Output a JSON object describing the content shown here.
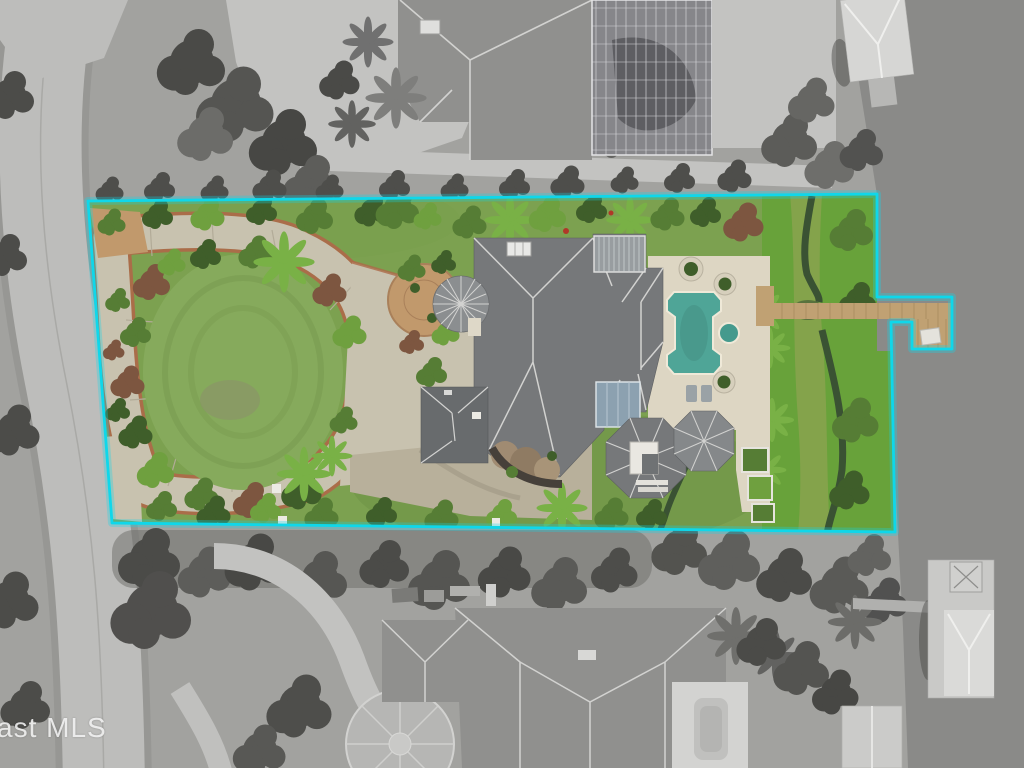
{
  "meta": {
    "kind": "aerial-drone-real-estate-photo",
    "subject": "Waterfront estate lot outlined in cyan; lot shown in color, surroundings desaturated grayscale",
    "width": 1024,
    "height": 768
  },
  "watermark": {
    "text": "ast MLS"
  },
  "scene": {
    "lot_features": [
      "oval front lawn with circular driveway loop",
      "main house with gray hip roof and conical turret",
      "screened and glass lanai roofs",
      "two octagonal gazebo roofs",
      "travertine pool deck",
      "roman-style swimming pool with spa",
      "mangrove marsh strip with tidal creek",
      "wood boardwalk to L-shaped dock with boat lift"
    ],
    "surroundings": [
      "curved street on left",
      "neighboring tiled-roof home with pool screen enclosure (top)",
      "neighboring home with circular paver court (bottom)",
      "gray river water on right",
      "two neighboring boathouse docks"
    ]
  },
  "colors": {
    "boundary": "#0fd7ea",
    "water": "#8a8a88",
    "road": "#bdbdbb",
    "base": "#a2a29f",
    "graytree": "#4c4c49",
    "grayroof": "#90908e",
    "graypaver": "#c3c3c1",
    "screen": "#86868a",
    "lawn": "#7ca150",
    "lawncircle": "#86aa5c",
    "marsh": "#68a23a",
    "creek": "#3a5233",
    "shrubdark": "#3f5e2a",
    "shrubmid": "#567d35",
    "shrublight": "#6fa03f",
    "palm": "#79b146",
    "mulch": "#7d5640",
    "concrete": "#c8c2af",
    "brick": "#ad6a49",
    "courtbrick": "#c1996c",
    "roofmain": "#76787a",
    "ridge": "#d2d2d0",
    "garage": "#686b6d",
    "turret": "#8b8e90",
    "glass": "#8ca1b0",
    "deck": "#ddd6c3",
    "pool": "#4fa597",
    "spa": "#459a8d",
    "wood": "#c0a173",
    "whitestruct": "#e9e7e1",
    "watermark": "#f2f2f2"
  }
}
